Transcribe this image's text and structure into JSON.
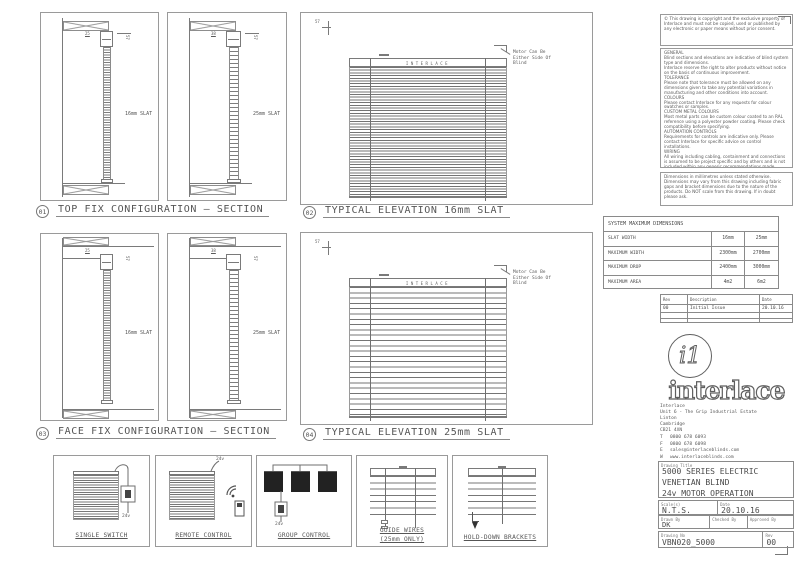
{
  "viewports": {
    "v01": {
      "num": "01",
      "title": "TOP FIX CONFIGURATION — SECTION"
    },
    "v02": {
      "num": "02",
      "title": "TYPICAL ELEVATION 16mm SLAT"
    },
    "v03": {
      "num": "03",
      "title": "FACE FIX CONFIGURATION — SECTION"
    },
    "v04": {
      "num": "04",
      "title": "TYPICAL ELEVATION 25mm SLAT"
    }
  },
  "sections": {
    "slat16_label": "16mm SLAT",
    "slat25_label": "25mm SLAT",
    "dim16_w": "25",
    "dim25_w": "38",
    "dim_h": "57"
  },
  "elevation": {
    "headrail_brand": "INTERLACE",
    "motor_note": "Motor Can Be\nEither Side Of\nBlind",
    "dim": "57"
  },
  "details": [
    {
      "label": "SINGLE SWITCH",
      "voltage": "24v"
    },
    {
      "label": "REMOTE CONTROL",
      "voltage": "24v"
    },
    {
      "label": "GROUP CONTROL",
      "voltage": "24v"
    },
    {
      "label": "GUIDE WIRES\n(25mm ONLY)"
    },
    {
      "label": "HOLD-DOWN BRACKETS"
    }
  ],
  "notes": {
    "copyright": "© This drawing is copyright and the exclusive property of Interlace and must not be copied, used or published by any electronic or paper means without prior consent.",
    "general": "GENERAL\nBlind sections and elevations are indicative of blind system type and dimensions.\nInterlace reserve the right to alter products without notice on the basis of continuous improvement.\nTOLERANCE\nPlease note that tolerance must be allowed on any dimensions given to take any potential variations in manufacturing and other conditions into account.\nCOLOURS\nPlease contact Interlace for any requests for colour swatches or samples.\nCUSTOM METAL COLOURS\nMost metal parts can be custom colour coated to an RAL reference using a polyester powder coating. Please check compatibility before specifying.\nAUTOMATION CONTROLS\nRequirements for controls are indicative only. Please contact Interlace for specific advice on control installations.\nWIRING\nAll wiring including cabling, containment and connections is assumed to be project specific and by others and is not included within any generic recommendations made.\nFIXING\nThis drawing does not take individual fixing situations into account. Interlace are not responsible for the substrate provided.",
    "dimensions": "Dimensions in millimetres unless stated otherwise.\nDimensions may vary from this drawing including fabric gaps and bracket dimensions due to the nature of the products. Do NOT scale from this drawing. If in doubt please ask."
  },
  "dims_table": {
    "header": "SYSTEM MAXIMUM DIMENSIONS",
    "rows": [
      [
        "SLAT WIDTH",
        "16mm",
        "25mm"
      ],
      [
        "MAXIMUM WIDTH",
        "2300mm",
        "2700mm"
      ],
      [
        "MAXIMUM DROP",
        "2400mm",
        "3000mm"
      ],
      [
        "MAXIMUM AREA",
        "4m2",
        "6m2"
      ]
    ]
  },
  "rev_table": {
    "headers": [
      "Rev",
      "Description",
      "Date"
    ],
    "rows": [
      [
        "00",
        "Initial Issue",
        "20.10.16"
      ],
      [
        "",
        "",
        ""
      ],
      [
        "",
        "",
        ""
      ]
    ]
  },
  "brand": {
    "logo_mark": "i1",
    "logo_text": "interlace",
    "address": "Interlace\nUnit 6 - The Grip Industrial Estate\nLinton\nCambridge\nCB21 4XN",
    "contacts": [
      {
        "k": "T",
        "v": "0800 678 6093"
      },
      {
        "k": "F",
        "v": "0800 678 6098"
      },
      {
        "k": "E",
        "v": "sales@interlaceblinds.com"
      },
      {
        "k": "W",
        "v": "www.interlaceblinds.com"
      }
    ]
  },
  "title_block": {
    "title_label": "Drawing Title",
    "title": "5000 SERIES ELECTRIC\nVENETIAN BLIND\n24v MOTOR OPERATION",
    "scale_label": "Scale(s)",
    "scale": "N.T.S.",
    "date_label": "Date",
    "date": "20.10.16",
    "drawn_label": "Drawn By",
    "drawn": "DK",
    "checked_label": "Checked By",
    "checked": "",
    "approved_label": "Approved By",
    "approved": "",
    "number_label": "Drawing No",
    "number": "VBN020_5000",
    "rev_label": "Rev",
    "rev": "00"
  }
}
